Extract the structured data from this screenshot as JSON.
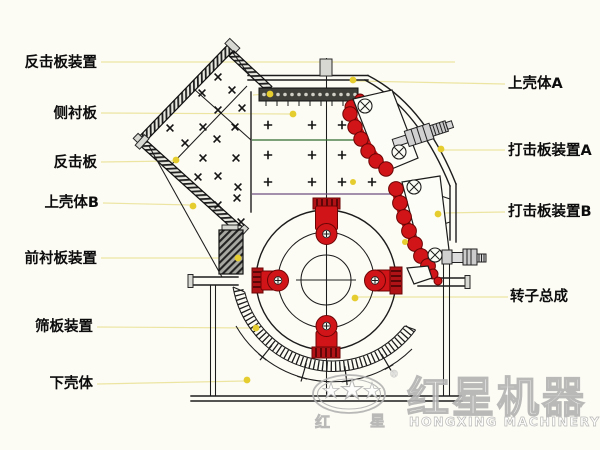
{
  "colors": {
    "background": "#fcfbf4",
    "line": "#1c1c1c",
    "red": "#d01418",
    "red_dark": "#6b0505",
    "leader": "#ece5a2",
    "dot": "#e6cd2f",
    "green_line": "#2f6b2d",
    "purple_line": "#6e4d80",
    "watermark": "#b2b2b2"
  },
  "labels": {
    "left": [
      "反击板装置",
      "侧衬板",
      "反击板",
      "上壳体B",
      "前衬板装置",
      "筛板装置",
      "下壳体"
    ],
    "right": [
      "上壳体A",
      "打击板装置A",
      "打击板装置B",
      "转子总成"
    ]
  },
  "watermark": {
    "cn_large": "红星机器",
    "en": "HONGXING MACHINERY",
    "registered": "®",
    "cn_small_1": "红",
    "cn_small_2": "星"
  }
}
